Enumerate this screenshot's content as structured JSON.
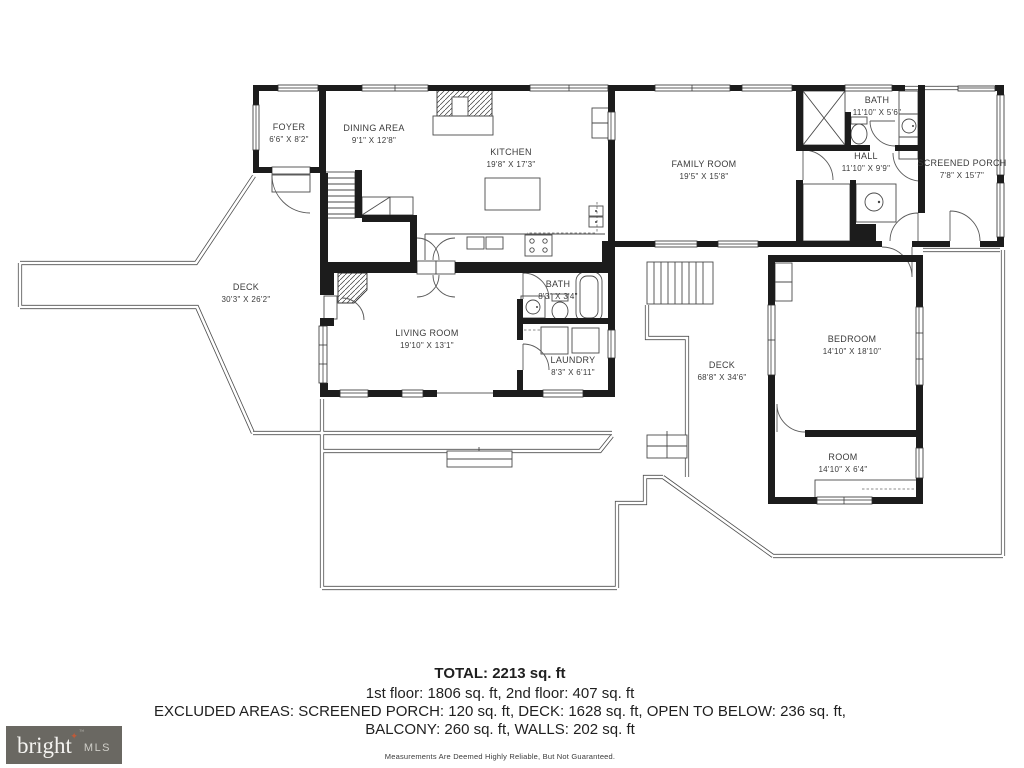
{
  "rooms": [
    {
      "name": "FOYER",
      "dims": "6'6\" X 8'2\""
    },
    {
      "name": "DINING AREA",
      "dims": "9'1\" X 12'8\""
    },
    {
      "name": "KITCHEN",
      "dims": "19'8\" X 17'3\""
    },
    {
      "name": "FAMILY ROOM",
      "dims": "19'5\" X 15'8\""
    },
    {
      "name": "BATH",
      "dims": "11'10\" X 5'6\""
    },
    {
      "name": "HALL",
      "dims": "11'10\" X 9'9\""
    },
    {
      "name": "SCREENED PORCH",
      "dims": "7'8\" X 15'7\""
    },
    {
      "name": "DECK",
      "dims": "30'3\" X 26'2\""
    },
    {
      "name": "LIVING ROOM",
      "dims": "19'10\" X 13'1\""
    },
    {
      "name": "BATH",
      "dims": "8'3\" X 3'4\""
    },
    {
      "name": "LAUNDRY",
      "dims": "8'3\" X 6'11\""
    },
    {
      "name": "DECK",
      "dims": "68'8\" X 34'6\""
    },
    {
      "name": "BEDROOM",
      "dims": "14'10\" X 18'10\""
    },
    {
      "name": "ROOM",
      "dims": "14'10\" X 6'4\""
    }
  ],
  "summary": {
    "total": "TOTAL: 2213 sq. ft",
    "floors": "1st floor: 1806 sq. ft, 2nd floor: 407 sq. ft",
    "excluded1": "EXCLUDED AREAS: SCREENED PORCH: 120 sq. ft, DECK: 1628 sq. ft, OPEN TO BELOW: 236 sq. ft,",
    "excluded2": "BALCONY: 260 sq. ft, WALLS: 202 sq. ft",
    "disclaimer": "Measurements Are Deemed Highly Reliable, But Not Guaranteed."
  },
  "logo": {
    "brand": "bright",
    "suffix": "MLS"
  },
  "icons": {
    "star": "✦",
    "tm": "™"
  },
  "colors": {
    "wall": "#1c1c1c",
    "thin_line": "#4a4a4a",
    "logo_bg": "#6a6862",
    "logo_accent": "#c05a38"
  }
}
